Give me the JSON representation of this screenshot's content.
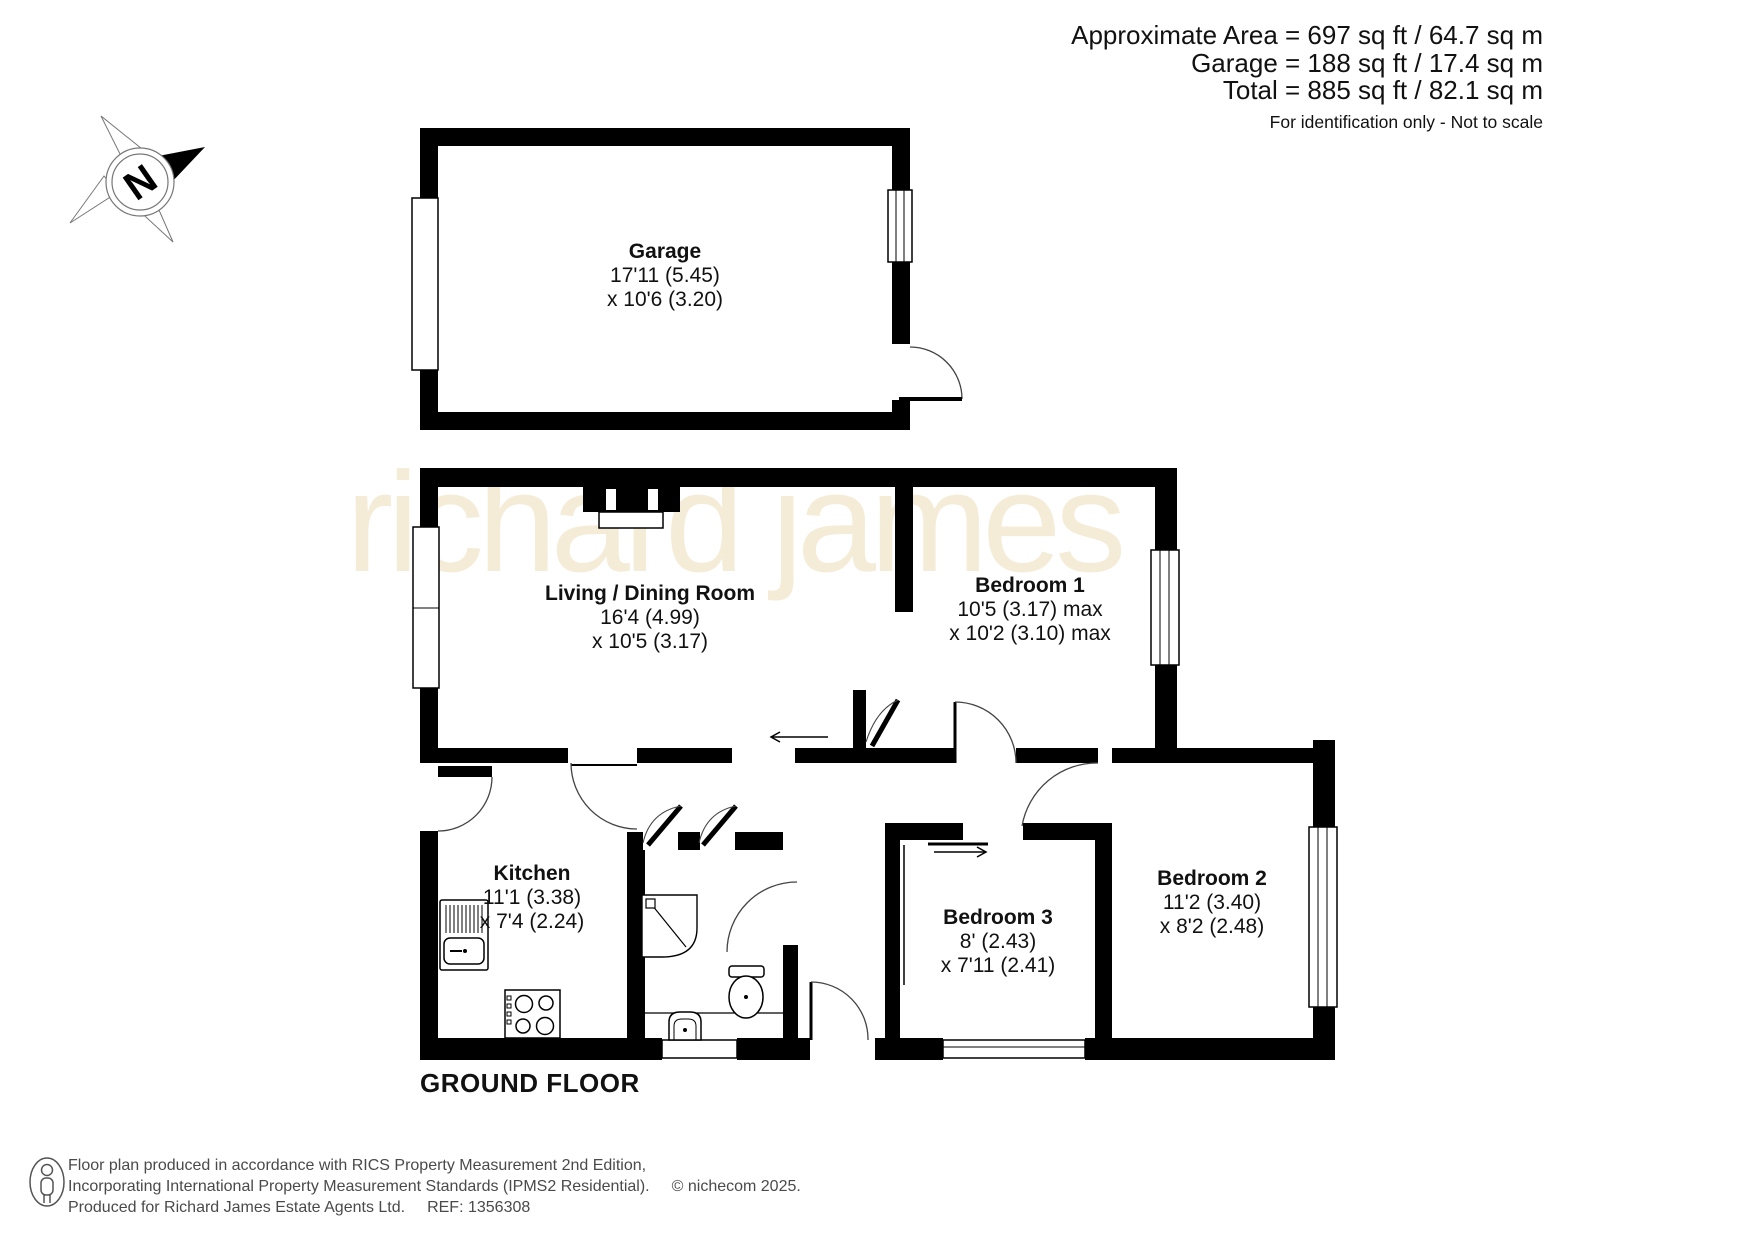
{
  "header": {
    "area_line": "Approximate Area = 697 sq ft / 64.7 sq m",
    "garage_line": "Garage = 188 sq ft / 17.4 sq m",
    "total_line": "Total = 885 sq ft / 82.1 sq m",
    "disclaimer": "For identification only - Not to scale"
  },
  "compass": {
    "label": "N"
  },
  "watermark": "richard james",
  "floor_label": "GROUND FLOOR",
  "rooms": {
    "garage": {
      "name": "Garage",
      "dim1": "17'11 (5.45)",
      "dim2": "x 10'6 (3.20)"
    },
    "living": {
      "name": "Living / Dining Room",
      "dim1": "16'4 (4.99)",
      "dim2": "x 10'5 (3.17)"
    },
    "bedroom1": {
      "name": "Bedroom 1",
      "dim1": "10'5 (3.17) max",
      "dim2": "x 10'2 (3.10) max"
    },
    "kitchen": {
      "name": "Kitchen",
      "dim1": "11'1 (3.38)",
      "dim2": "x 7'4 (2.24)"
    },
    "bedroom3": {
      "name": "Bedroom 3",
      "dim1": "8' (2.43)",
      "dim2": "x 7'11 (2.41)"
    },
    "bedroom2": {
      "name": "Bedroom 2",
      "dim1": "11'2 (3.40)",
      "dim2": "x 8'2 (2.48)"
    }
  },
  "footer": {
    "line1": "Floor plan produced in accordance with RICS Property Measurement 2nd Edition,",
    "line2a": "Incorporating International Property Measurement Standards (IPMS2 Residential).",
    "line2b": "© nichecom 2025.",
    "line3a": "Produced for Richard James Estate Agents Ltd.",
    "line3b": "REF: 1356308"
  },
  "colors": {
    "wall": "#000000",
    "watermark": "#f5ecd8",
    "footer_text": "#4a4a4a"
  }
}
